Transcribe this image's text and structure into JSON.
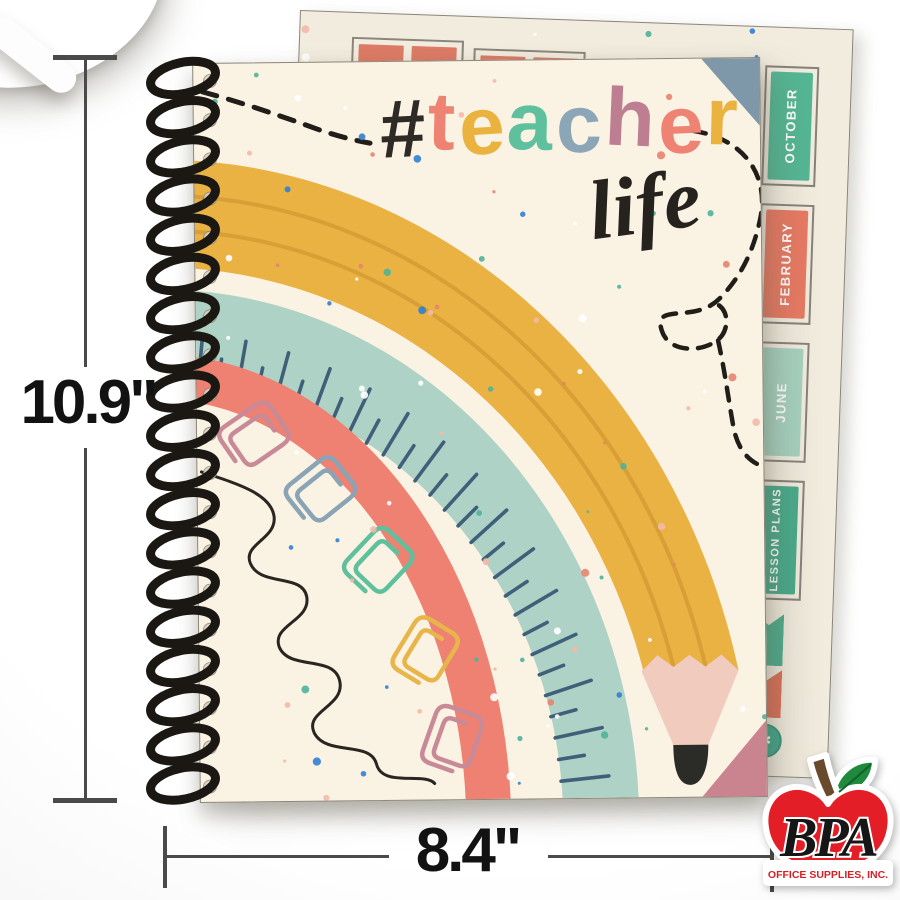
{
  "scene": {
    "description": "Spiral-bound teacher planner product photo with size annotations"
  },
  "dimensions": {
    "height_label": "10.9\"",
    "width_label": "8.4\""
  },
  "cover": {
    "title_letters": [
      {
        "char": "#",
        "color": "#2e2a26"
      },
      {
        "char": "t",
        "color": "#ee8273"
      },
      {
        "char": "e",
        "color": "#eab33f"
      },
      {
        "char": "a",
        "color": "#5ec09c"
      },
      {
        "char": "c",
        "color": "#8ba6b7"
      },
      {
        "char": "h",
        "color": "#bd7e92"
      },
      {
        "char": "e",
        "color": "#ee8273"
      },
      {
        "char": "r",
        "color": "#eab33f"
      }
    ],
    "script_word": "life",
    "palette": {
      "cover_cream": "#faf2e3",
      "pencil_yellow": "#e9b243",
      "pencil_stripe": "#d79f35",
      "pencil_wood": "#f0cbbe",
      "pencil_tip": "#2b2b28",
      "ruler_teal": "#aed3c6",
      "ruler_tick": "#40607a",
      "arc_coral": "#ee8172",
      "corner_slate": "#7f98a9",
      "corner_rose": "#c98490",
      "ink_black": "#26221d"
    },
    "clip_colors": [
      "#c98a97",
      "#8aa4b5",
      "#5ec09c",
      "#e8b54a",
      "#c98a97"
    ],
    "speckle_colors": [
      "#e8826e",
      "#2f7fd1",
      "#4fb39a",
      "#ffffff",
      "#f3b9a9"
    ]
  },
  "sheet": {
    "paper_color": "#f2ecdf",
    "tabs": [
      {
        "label": "OCTOBER",
        "fill": "#54b795",
        "text_color": "#ffffff"
      },
      {
        "label": "FEBRUARY",
        "fill": "#e87a63",
        "text_color": "#ffffff"
      },
      {
        "label": "JUNE",
        "fill": "#a7d2c0",
        "text_color": "#ffffff"
      },
      {
        "label": "LESSON PLANS",
        "fill": "#49ab8c",
        "text_color": "#ffffff"
      }
    ],
    "flags": [
      {
        "color": "#4fae8e"
      },
      {
        "color": "#dd7259"
      }
    ],
    "badge": {
      "glyph": "✱",
      "fill": "#3fa98c"
    },
    "header_cell_color": "#dd7b66"
  },
  "logo": {
    "name": "BPA",
    "tagline": "OFFICE SUPPLIES, INC.",
    "apple_red": "#e31e26",
    "leaf_green": "#1f8a3d",
    "stem_brown": "#6a4a2d",
    "tagline_red": "#d61f26"
  }
}
